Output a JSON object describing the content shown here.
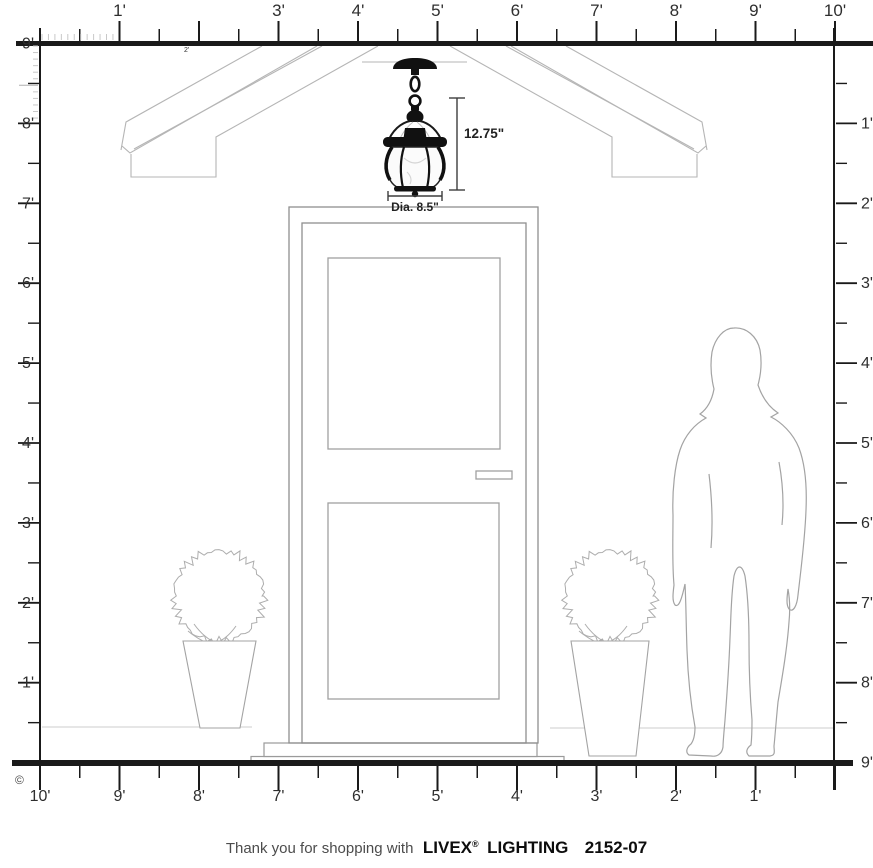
{
  "rulers": {
    "top": {
      "labels": [
        "1'",
        "",
        "3'",
        "4'",
        "5'",
        "6'",
        "7'",
        "8'",
        "9'",
        "10'"
      ],
      "glitch_label": "2'"
    },
    "left": {
      "labels": [
        "9'",
        "8'",
        "7'",
        "6'",
        "5'",
        "4'",
        "3'",
        "2'",
        "1'"
      ]
    },
    "right": {
      "labels": [
        "1'",
        "2'",
        "3'",
        "4'",
        "5'",
        "6'",
        "7'",
        "8'",
        "9'"
      ]
    },
    "bottom": {
      "labels": [
        "10'",
        "9'",
        "8'",
        "7'",
        "6'",
        "5'",
        "4'",
        "3'",
        "2'",
        "1'"
      ]
    }
  },
  "fixture": {
    "height_label": "12.75\"",
    "diameter_label": "Dia. 8.5\""
  },
  "footer": {
    "prefix": "Thank you for shopping with",
    "brand": "LIVEX",
    "registered": "®",
    "brand_suffix": "LIGHTING",
    "model": "2152-07"
  },
  "copyright_symbol": "©",
  "colors": {
    "ink": "#1a1a1a",
    "sketch_mid": "#9c9c9c",
    "sketch_light": "#b8b8b8",
    "label_text": "#2e2e2e"
  }
}
